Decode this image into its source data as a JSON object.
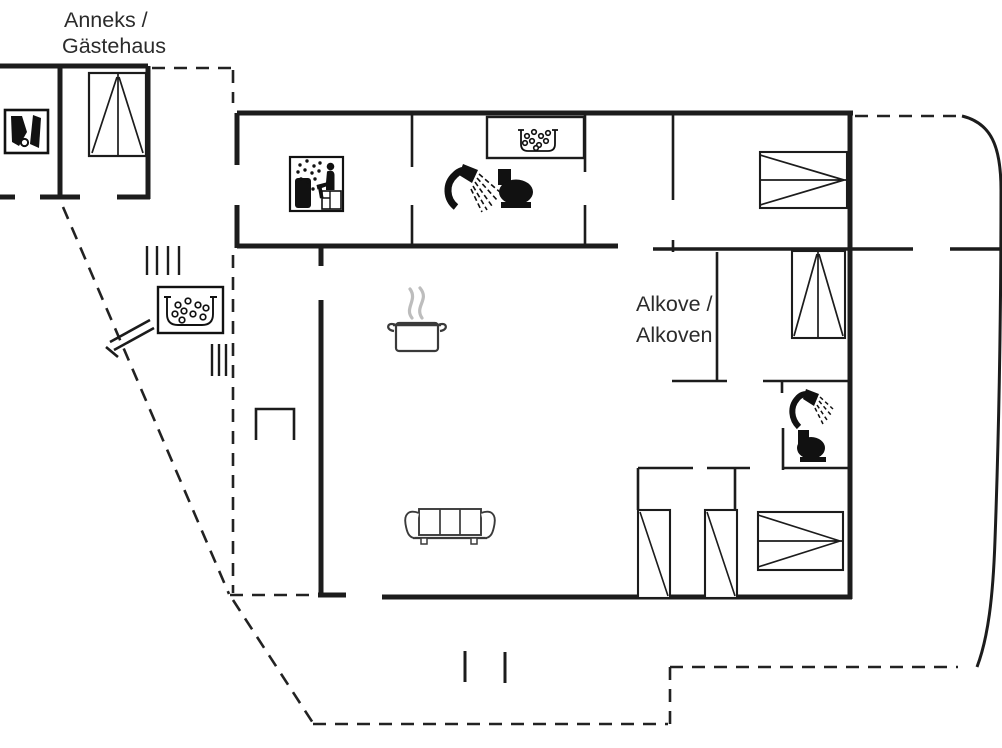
{
  "labels": {
    "annex_line1": "Anneks /",
    "annex_line2": "Gästehaus",
    "alcove_line1": "Alkove /",
    "alcove_line2": "Alkoven"
  },
  "colors": {
    "background": "#ffffff",
    "wall": "#1c1c1c",
    "icon": "#111111",
    "text": "#2b2b2b",
    "steam": "#bdbdbd"
  },
  "icons": [
    "shower-icon-annex-entry",
    "wardrobe-bed-icon-annex",
    "sauna-icon",
    "washbasin-icon",
    "shower-icon-bathroom-1",
    "toilet-icon-bathroom-1",
    "hot-tub-icon",
    "stairs-hatch-marks",
    "cooking-pot-icon",
    "fireplace-bracket",
    "sofa-icon",
    "double-bed-icon-top-right",
    "alcove-bed-icon",
    "single-bed-icon-left",
    "single-bed-icon-right",
    "double-bed-icon-bottom-right",
    "shower-icon-bathroom-2",
    "toilet-icon-bathroom-2"
  ]
}
